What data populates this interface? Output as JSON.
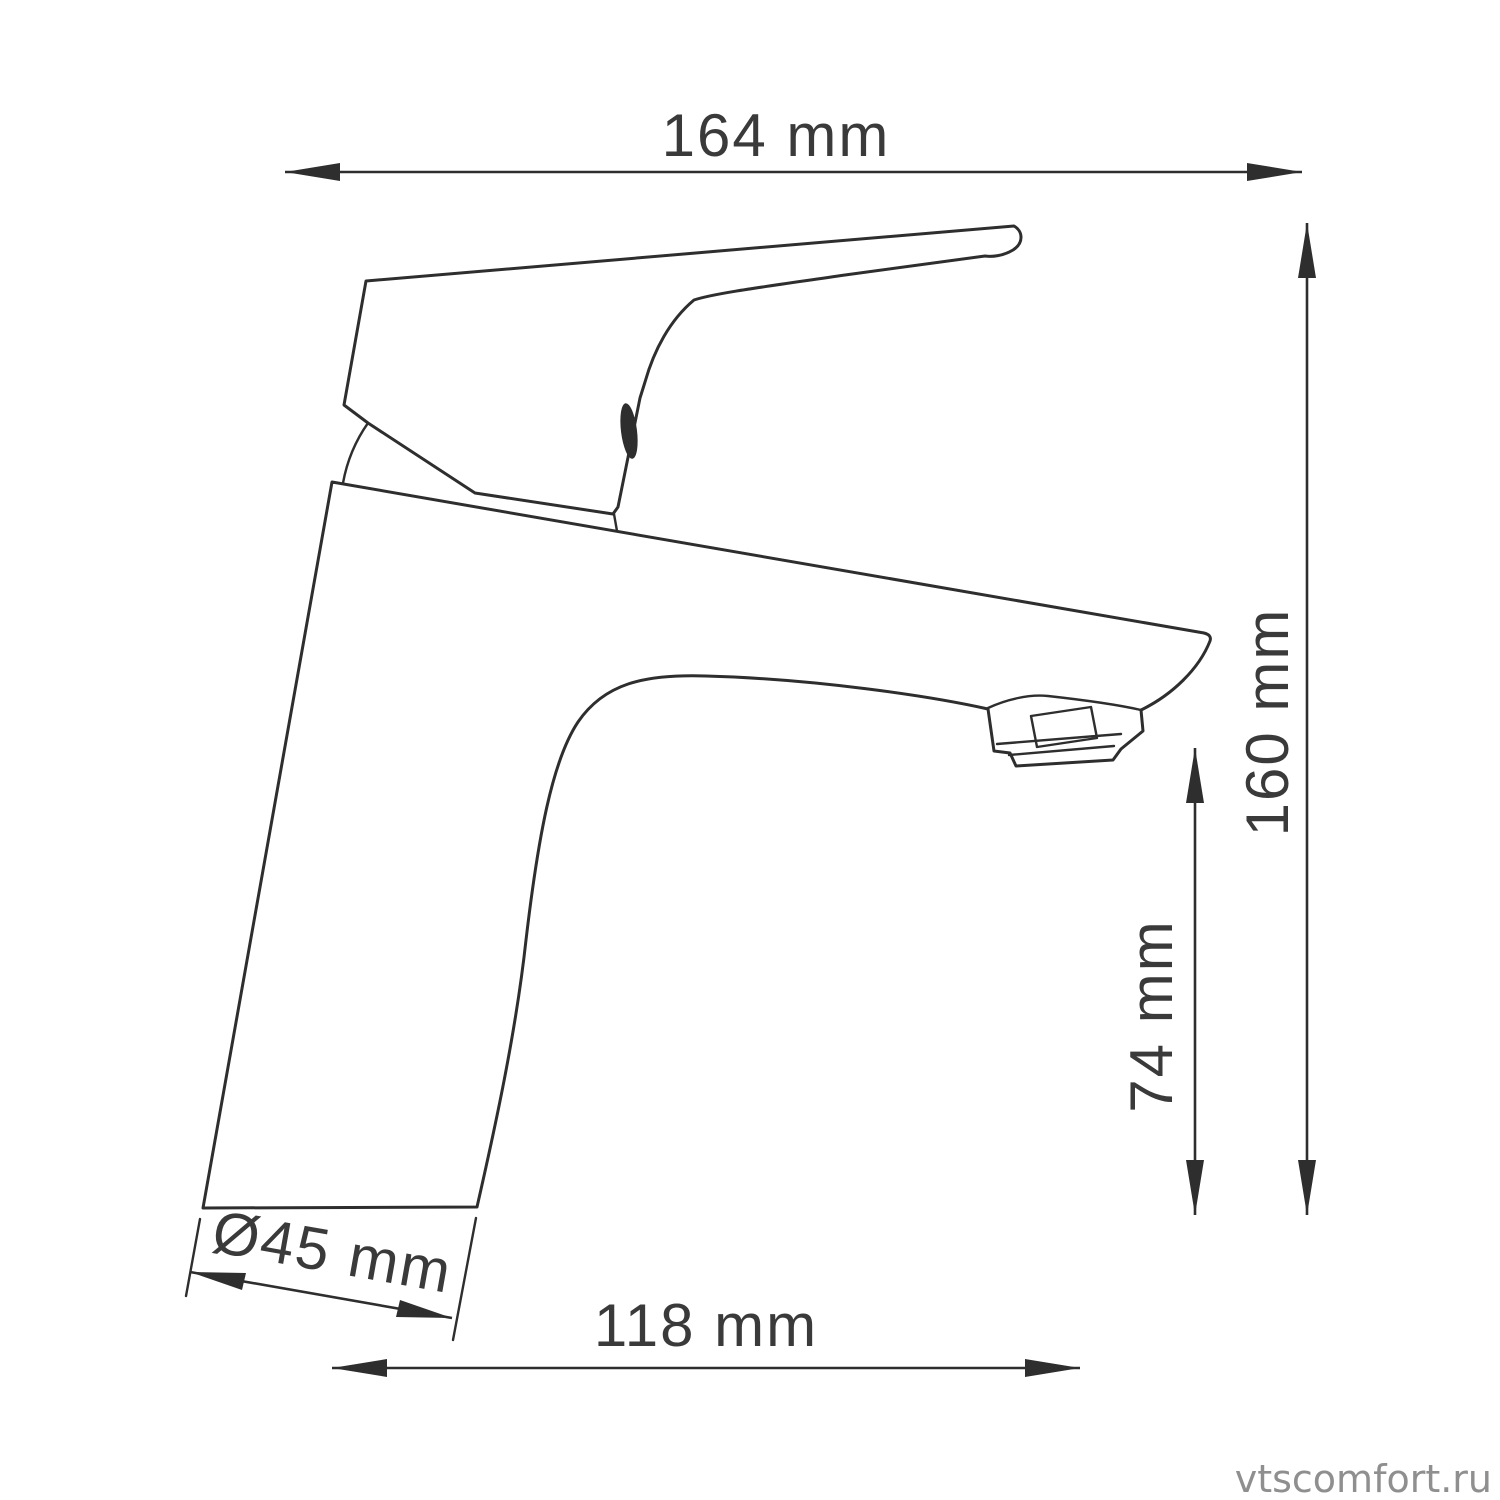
{
  "page": {
    "background": "#ffffff"
  },
  "drawing": {
    "stroke_color": "#2e2e2e",
    "label_color": "#3a3a3a"
  },
  "dimensions": {
    "overall_width": {
      "label": "164 mm"
    },
    "overall_height": {
      "label": "160 mm"
    },
    "spout_height": {
      "label": "74 mm"
    },
    "base_diameter": {
      "label": "Ø45 mm"
    },
    "spout_reach": {
      "label": "118 mm"
    }
  },
  "watermark": {
    "text": "vtscomfort.ru",
    "color": "#8f8f8f"
  }
}
